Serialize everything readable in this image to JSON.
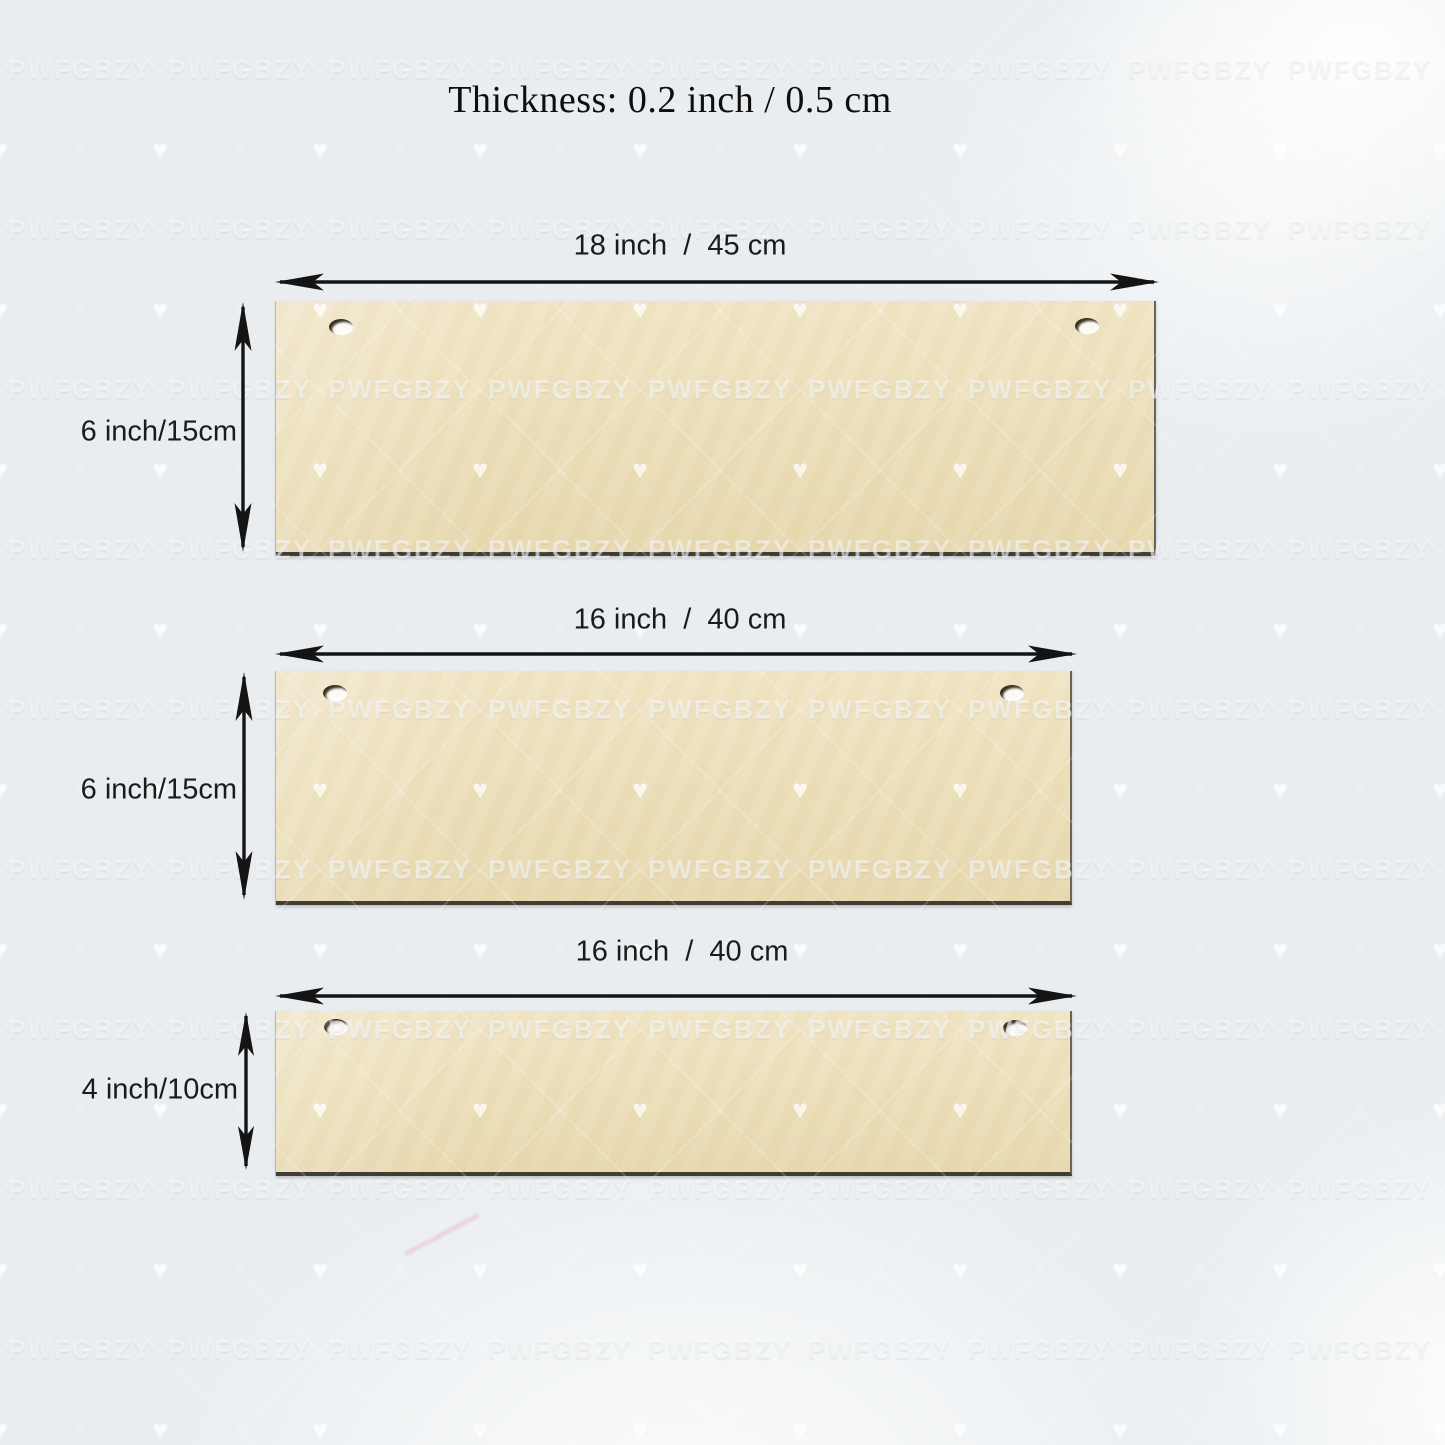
{
  "title": "Thickness: 0.2 inch / 0.5 cm",
  "watermark": {
    "text": "PWFGBZY",
    "icon": "heart-icon"
  },
  "planks": [
    {
      "width_label": "18 inch  /  45 cm",
      "height_label": "6 inch/15cm"
    },
    {
      "width_label": "16 inch  /  40 cm",
      "height_label": "6 inch/15cm"
    },
    {
      "width_label": "16 inch  /  40 cm",
      "height_label": "4 inch/10cm"
    }
  ],
  "colors": {
    "background": "#e9edf0",
    "wood": "#ecdfba",
    "wood_edge_dark": "#403d34",
    "arrow": "#141414",
    "label_text": "#1b1b1b",
    "watermark": "#ffffff"
  }
}
